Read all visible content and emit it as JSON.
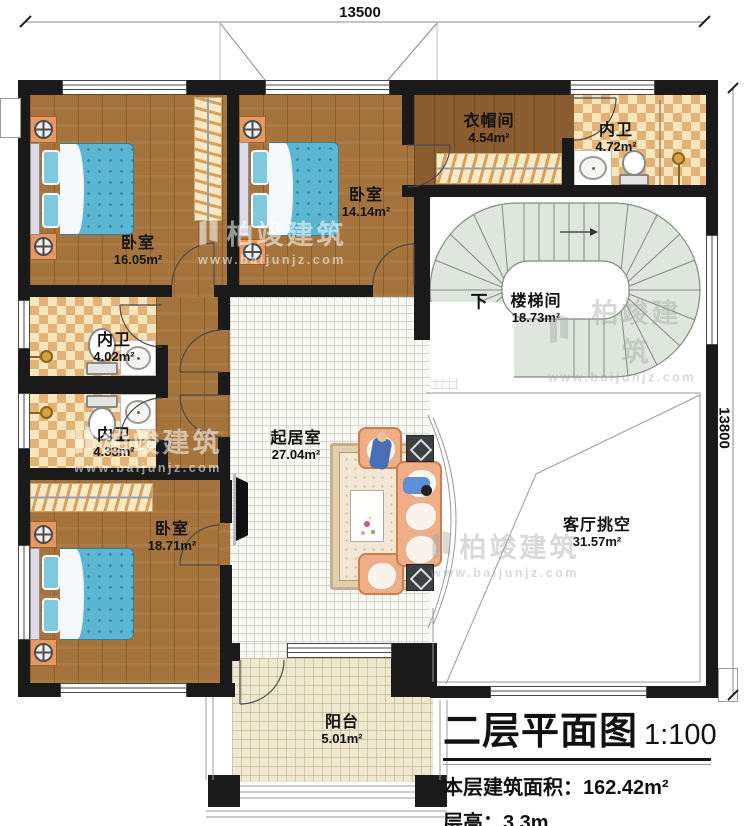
{
  "dimensions": {
    "top": "13500",
    "right": "13800"
  },
  "rooms": [
    {
      "id": "bedroom-1",
      "name": "卧室",
      "area": "16.05m²"
    },
    {
      "id": "bedroom-2",
      "name": "卧室",
      "area": "14.14m²"
    },
    {
      "id": "cloakroom",
      "name": "衣帽间",
      "area": "4.54m²"
    },
    {
      "id": "bath-top",
      "name": "内卫",
      "area": "4.72m²"
    },
    {
      "id": "bath-mid-a",
      "name": "内卫",
      "area": "4.02m²"
    },
    {
      "id": "bath-mid-b",
      "name": "内卫",
      "area": "4.33m²"
    },
    {
      "id": "bedroom-3",
      "name": "卧室",
      "area": "18.71m²"
    },
    {
      "id": "living",
      "name": "起居室",
      "area": "27.04m²"
    },
    {
      "id": "void",
      "name": "客厅挑空",
      "area": "31.57m²"
    },
    {
      "id": "balcony",
      "name": "阳台",
      "area": "5.01m²"
    }
  ],
  "stair": {
    "name": "楼梯间",
    "area": "18.73m²",
    "down": "下"
  },
  "watermark": {
    "brand": "柏竣建筑",
    "url": "www.baijunjz.com"
  },
  "titleblock": {
    "title": "二层平面图",
    "scale": "1:100",
    "area_label": "本层建筑面积：",
    "area_value": "162.42m²",
    "height_label": "层高：",
    "height_value": "3.3m"
  },
  "colors": {
    "wall": "#1a1a1a",
    "wood": "#A5743C",
    "tile_checker": "#E4B274",
    "stair_fill": "#DEE6DD",
    "bed": "#5CB6D2",
    "sofa": "#EFAE85"
  }
}
